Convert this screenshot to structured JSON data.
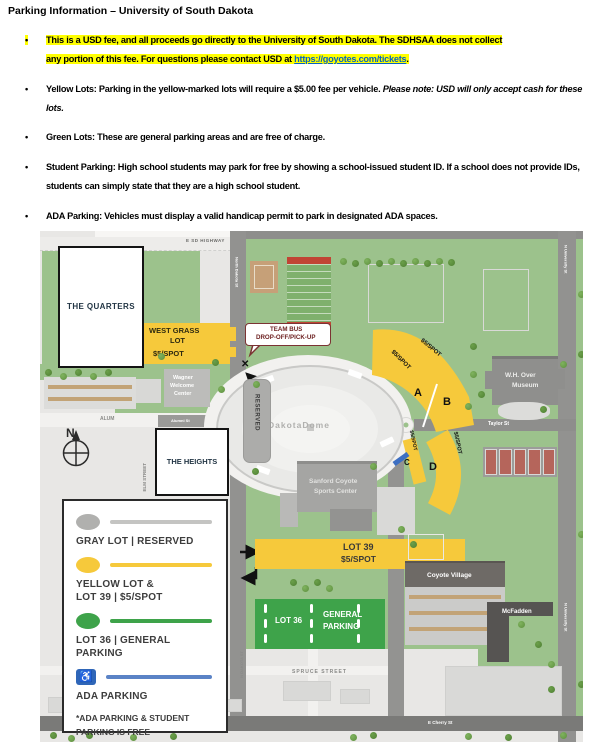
{
  "document": {
    "title": "Parking Information – University of South Dakota",
    "marker": "•",
    "bullets": {
      "b1_line1": "This is a USD fee, and all proceeds go directly to the University of South Dakota. The SDHSAA does not collect",
      "b1_line2": "any portion of this fee. For questions please contact USD at ",
      "b1_link": "https://goyotes.com/tickets",
      "b1_after": ".",
      "b2_text": "Yellow Lots: Parking in the yellow-marked lots will require a $5.00 fee per vehicle. ",
      "b2_italic": "Please note: USD will only accept cash for these lots.",
      "b3_text": "Green Lots: These are general parking areas and are free of charge.",
      "b4_text": "Student Parking: High school students may park for free by showing a school-issued student ID. If a school does not provide IDs, students can simply state that they are a high school student.",
      "b5_text": "ADA Parking: Vehicles must display a valid handicap permit to park in designated ADA spaces."
    }
  },
  "map": {
    "labels": {
      "quarters": "THE QUARTERS",
      "heights": "THE HEIGHTS",
      "west_grass_1": "WEST GRASS",
      "west_grass_2": "LOT",
      "spot": "$5/SPOT",
      "team_bus_1": "TEAM BUS",
      "team_bus_2": "DROP-OFF/PICK-UP",
      "reserved": "RESERVED",
      "dome": "DakotaDome",
      "sanford_1": "Sanford Coyote",
      "sanford_2": "Sports Center",
      "museum_1": "W.H. Over",
      "museum_2": "Museum",
      "wagner_1": "Wagner",
      "wagner_2": "Welcome",
      "wagner_3": "Center",
      "lot_a": "A",
      "lot_b": "B",
      "lot_c": "C",
      "lot_d": "D",
      "lot39_1": "LOT 39",
      "lot39_2": "$5/SPOT",
      "lot36": "LOT 36",
      "general_1": "GENERAL",
      "general_2": "PARKING",
      "coyote_village": "Coyote Village",
      "mcfadden": "McFadden",
      "x_marker": "✕",
      "compass_n": "N"
    },
    "streets": {
      "highway": "E SD HIGHWAY",
      "north_dakota": "North Dakota St",
      "alum": "ALUM",
      "alumni": "Alumni St",
      "elm": "ELM STREET",
      "taylor": "Taylor St",
      "rose": "Rose St",
      "n_university": "N University St",
      "spruce": "SPRUCE STREET",
      "n_dakota_vert": "N DAKOTA ST",
      "cherry": "E Cherry St"
    },
    "legend": {
      "gray": "GRAY LOT | RESERVED",
      "yellow_1": "YELLOW LOT &",
      "yellow_2": "LOT 39 | $5/SPOT",
      "green_1": "LOT 36 | GENERAL",
      "green_2": "PARKING",
      "ada": "ADA PARKING",
      "ada_icon": "♿",
      "note_1": "*ADA PARKING & STUDENT",
      "note_2": "PARKING IS FREE"
    },
    "colors": {
      "lot_yellow": "#F6C93B",
      "lot_green": "#3EA34A",
      "campus_green": "#9CC28C",
      "ada_blue": "#2F66B8",
      "ada_line_blue": "#5B83C6",
      "gray_lot": "#ACACAA",
      "road_gray": "#929290",
      "bubble_maroon": "#7B3333",
      "highlight_yellow": "#FFFF00",
      "link_blue": "#0563C1"
    }
  }
}
